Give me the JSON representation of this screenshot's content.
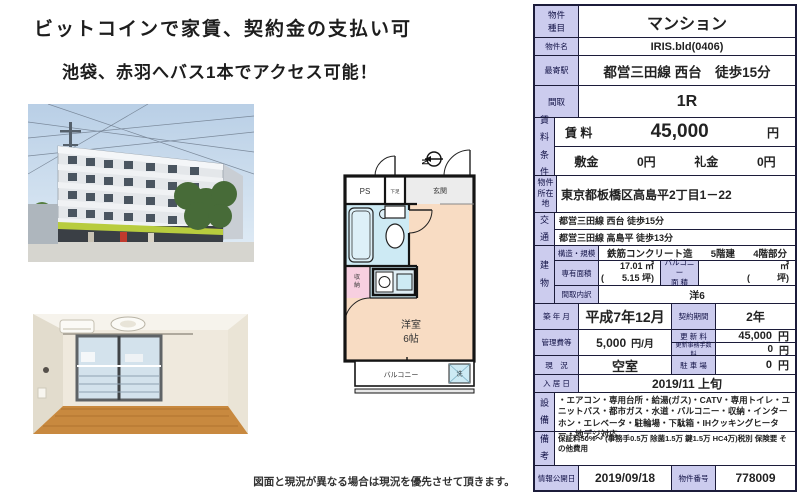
{
  "colors": {
    "label_bg": "#ccccee",
    "border": "#1c1c3a",
    "room_peach": "#f8dcc3",
    "bath_blue": "#cdeaf4",
    "closet_pink": "#f7cfe0",
    "sign_green": "#b8cc3e"
  },
  "left": {
    "headline1": "ビットコインで家賃、契約金の支払い可",
    "headline2": "池袋、赤羽へバス1本でアクセス可能！",
    "disclaimer": "図面と現況が異なる場合は現況を優先させて頂きます。"
  },
  "floorplan": {
    "north": "N",
    "ps": "PS",
    "shoe": "下足",
    "entrance": "玄関",
    "closet1": "収",
    "closet2": "納",
    "room_line1": "洋室",
    "room_line2": "6帖",
    "balcony": "バルコニー",
    "washer": "洗"
  },
  "table": {
    "type": {
      "label": "物件種目",
      "value": "マンション"
    },
    "name": {
      "label": "物件名",
      "value": "IRIS.bld(0406)"
    },
    "station": {
      "label": "最寄駅",
      "value": "都営三田線 西台　徒歩15分"
    },
    "layout": {
      "label": "間取",
      "value": "1R"
    },
    "rent": {
      "label": "賃料条件",
      "rent_label": "賃 料",
      "value": "45,000",
      "unit": "円",
      "deposit_label": "敷金",
      "deposit_value": "0円",
      "key_label": "礼金",
      "key_value": "0円"
    },
    "address": {
      "label": "物件所在地",
      "value": "東京都板橋区高島平2丁目1－22"
    },
    "access": {
      "label": "交通",
      "line1": "都営三田線 西台 徒歩15分",
      "line2": "都営三田線 高島平 徒歩13分"
    },
    "building": {
      "label": "建物",
      "structure_label": "構造・規模",
      "structure_value": "鉄筋コンクリート造",
      "floors": "5階建",
      "floor_part": "4階部分",
      "area_label": "専有面積",
      "area_m2": "17.01 ㎡",
      "area_tsubo": "(　　5.15 坪)",
      "balcony_label1": "バルコニー",
      "balcony_label2": "面 積",
      "balcony_m2": "㎡",
      "balcony_tsubo": "(　　　坪)",
      "layout_detail_label": "間取内訳",
      "layout_detail_value": "洋6"
    },
    "built": {
      "label": "築 年 月",
      "value": "平成7年12月"
    },
    "contract": {
      "label": "契約期間",
      "value": "2年"
    },
    "fee": {
      "label": "管理費等",
      "value": "5,000",
      "unit": "円/月"
    },
    "renewal": {
      "label": "更 新 料",
      "value": "45,000",
      "unit": "円",
      "admin_label": "更新事務手数料",
      "admin_value": "0",
      "admin_unit": "円"
    },
    "status": {
      "label": "現　況",
      "value": "空室"
    },
    "parking": {
      "label": "駐 車 場",
      "value": "0",
      "unit": "円"
    },
    "movein": {
      "label": "入 居 日",
      "value": "2019/11 上旬"
    },
    "equipment": {
      "label": "設備",
      "value": "・エアコン・専用台所・給湯(ガス)・CATV・専用トイレ・ユニットバス・都市ガス・水道・バルコニー・収納・インターホン・エレベータ・駐輪場・下駄箱・IHクッキングヒーター・地デジ対応"
    },
    "remarks": {
      "label": "備考",
      "value": "保証料50%～ (事務手0.5万 除菌1.5万 鍵1.5万 HC4万)税別 保険要 その他費用"
    },
    "published": {
      "label": "情報公開日",
      "value": "2019/09/18"
    },
    "property_no": {
      "label": "物件番号",
      "value": "778009"
    }
  }
}
